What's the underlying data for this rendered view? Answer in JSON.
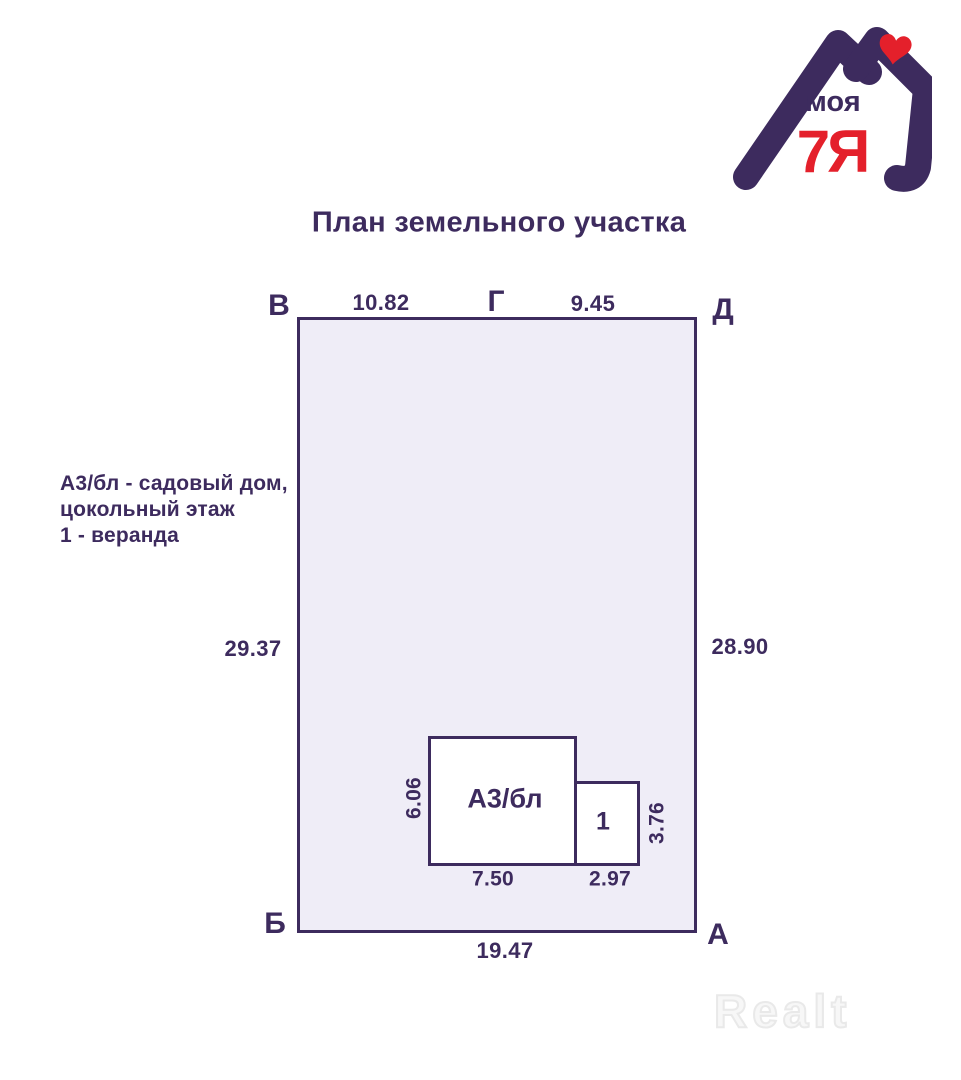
{
  "logo": {
    "word": "моя",
    "brand": "7Я"
  },
  "title": "План земельного участка",
  "legend": {
    "lines": [
      "А3/бл - садовый дом,",
      "цокольный этаж",
      "1 - веранда"
    ]
  },
  "plot": {
    "corner_top_left": "В",
    "corner_top_mid": "Г",
    "corner_top_right": "Д",
    "corner_bottom_left": "Б",
    "corner_bottom_right": "А",
    "len_top_left": "10.82",
    "len_top_right": "9.45",
    "len_left": "29.37",
    "len_right": "28.90",
    "len_bottom": "19.47"
  },
  "building": {
    "label": "А3/бл",
    "width": "7.50",
    "height": "6.06",
    "annex_label": "1",
    "annex_width": "2.97",
    "annex_height": "3.76"
  },
  "watermark": "Realt",
  "colors": {
    "purple": "#3d2b5e",
    "red": "#e4202b",
    "plot_fill": "#efedf7",
    "watermark_gray": "#e9e9e9"
  }
}
